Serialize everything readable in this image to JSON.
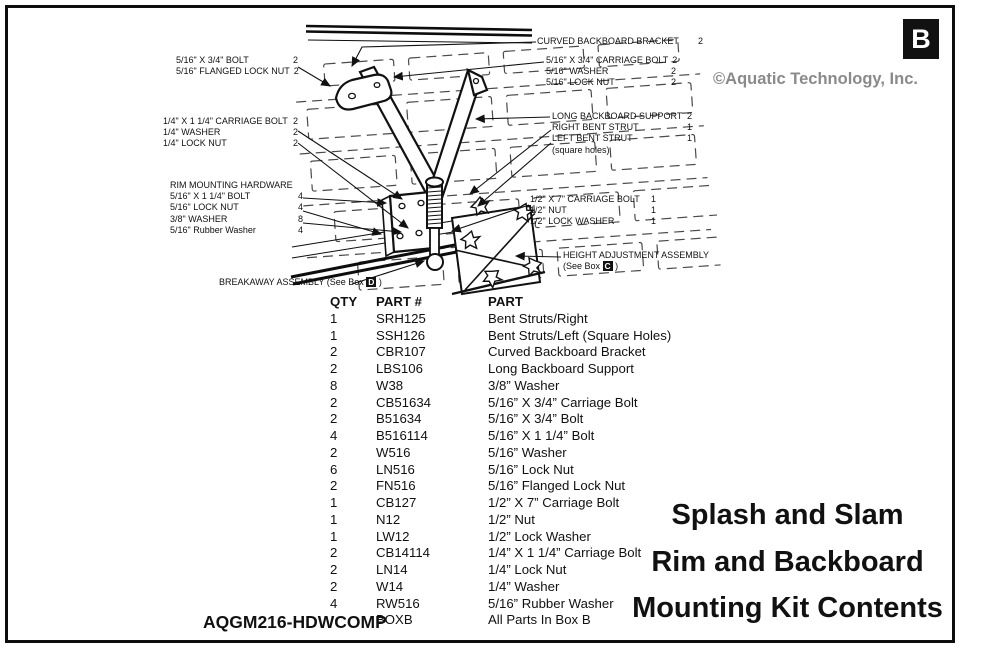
{
  "frame": {
    "corner_tag": "B"
  },
  "header": {
    "copyright": "©Aquatic Technology, Inc."
  },
  "callouts": {
    "bolt_group": {
      "rows": [
        {
          "label": "5/16\" X 3/4\" BOLT",
          "qty": "2"
        },
        {
          "label": "5/16\" FLANGED LOCK NUT",
          "qty": "2"
        }
      ]
    },
    "quarter_group": {
      "rows": [
        {
          "label": "1/4\" X 1 1/4\" CARRIAGE BOLT",
          "qty": "2"
        },
        {
          "label": "1/4\" WASHER",
          "qty": "2"
        },
        {
          "label": "1/4\" LOCK NUT",
          "qty": "2"
        }
      ]
    },
    "rim_group": {
      "title": "RIM MOUNTING HARDWARE",
      "rows": [
        {
          "label": "5/16\" X 1 1/4\" BOLT",
          "qty": "4"
        },
        {
          "label": "5/16\"  LOCK NUT",
          "qty": "4"
        },
        {
          "label": "3/8\" WASHER",
          "qty": "8"
        },
        {
          "label": "5/16\" Rubber Washer",
          "qty": "4"
        }
      ]
    },
    "breakaway": {
      "prefix": "BREAKAWAY ASSEMBLY (See Box ",
      "box": "D",
      "suffix": " )"
    },
    "curved_bracket": {
      "rows": [
        {
          "label": "CURVED BACKBOARD BRACKET",
          "qty": "2"
        }
      ]
    },
    "carriage_group": {
      "rows": [
        {
          "label": "5/16\" X 3/4\" CARRIAGE BOLT",
          "qty": "2"
        },
        {
          "label": "5/16\" WASHER",
          "qty": "2"
        },
        {
          "label": "5/16\" LOCK NUT",
          "qty": "2"
        }
      ]
    },
    "support_group": {
      "rows": [
        {
          "label": "LONG BACKBOARD SUPPORT",
          "qty": "2"
        },
        {
          "label": "RIGHT BENT STRUT",
          "qty": "1"
        },
        {
          "label": "LEFT BENT STRUT",
          "qty": "1"
        }
      ],
      "note": "(square holes)"
    },
    "half_group": {
      "rows": [
        {
          "label": "1/2\" X 7\" CARRIAGE BOLT",
          "qty": "1"
        },
        {
          "label": "1/2\" NUT",
          "qty": "1"
        },
        {
          "label": "1/2\" LOCK WASHER",
          "qty": "1"
        }
      ]
    },
    "height_adjust": {
      "line1": "HEIGHT ADJUSTMENT ASSEMBLY",
      "prefix": "(See Box ",
      "box": "C",
      "suffix": " )"
    }
  },
  "table": {
    "headers": [
      "QTY",
      "PART #",
      "PART"
    ],
    "rows": [
      [
        "1",
        "SRH125",
        "Bent Struts/Right"
      ],
      [
        "1",
        "SSH126",
        "Bent Struts/Left (Square Holes)"
      ],
      [
        "2",
        "CBR107",
        "Curved Backboard Bracket"
      ],
      [
        "2",
        "LBS106",
        "Long Backboard Support"
      ],
      [
        "8",
        "W38",
        "3/8” Washer"
      ],
      [
        "2",
        "CB51634",
        "5/16” X 3/4” Carriage Bolt"
      ],
      [
        "2",
        "B51634",
        "5/16” X 3/4”  Bolt"
      ],
      [
        "4",
        "B516114",
        "5/16” X 1 1/4” Bolt"
      ],
      [
        "2",
        "W516",
        "5/16” Washer"
      ],
      [
        "6",
        "LN516",
        "5/16” Lock Nut"
      ],
      [
        "2",
        "FN516",
        "5/16” Flanged Lock Nut"
      ],
      [
        "1",
        "CB127",
        "1/2” X 7” Carriage Bolt"
      ],
      [
        "1",
        "N12",
        "1/2” Nut"
      ],
      [
        "1",
        "LW12",
        "1/2” Lock Washer"
      ],
      [
        "2",
        "CB14114",
        "1/4” X 1 1/4” Carriage Bolt"
      ],
      [
        "2",
        "LN14",
        "1/4” Lock Nut"
      ],
      [
        "2",
        "W14",
        "1/4” Washer"
      ],
      [
        "4",
        "RW516",
        "5/16” Rubber Washer"
      ],
      [
        "",
        "BOXB",
        "All Parts In Box B"
      ]
    ]
  },
  "title": {
    "lines": [
      "Splash and Slam",
      "Rim and Backboard",
      "Mounting Kit Contents"
    ]
  },
  "footer": {
    "code": "AQGM216-HDWCOMP"
  }
}
